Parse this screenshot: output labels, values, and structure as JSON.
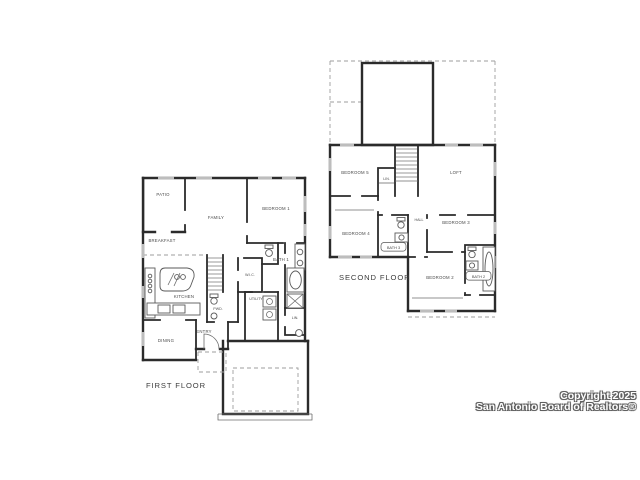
{
  "colors": {
    "background": "#ffffff",
    "wall": "#2b2b2b",
    "fixture_line": "#5a5a5a",
    "window": "#bdbdbd",
    "dashed_line": "#9e9e9e",
    "label_text": "#4a4a4a",
    "watermark_text": "#ffffff",
    "watermark_outline": "#5f5f5f"
  },
  "first_floor": {
    "title": "FIRST FLOOR",
    "rooms": {
      "patio": "PATIO",
      "family": "FAMILY",
      "bedroom1": "BEDROOM 1",
      "breakfast": "BREAKFAST",
      "kitchen": "KITCHEN",
      "dining": "DINING",
      "entry": "ENTRY",
      "powder": "PWD.",
      "utility": "UTILITY",
      "bath1": "BATH 1",
      "wic": "W.I.C.",
      "linen": "LIN."
    }
  },
  "second_floor": {
    "title": "SECOND FLOOR",
    "rooms": {
      "bedroom5": "BEDROOM 5",
      "loft": "LOFT",
      "bedroom4": "BEDROOM 4",
      "hall": "HALL",
      "bedroom3": "BEDROOM 3",
      "bath3": "BATH 3",
      "bedroom2": "BEDROOM 2",
      "bath2": "BATH 2",
      "linen": "LIN."
    }
  },
  "watermark": {
    "line1": "Copyright 2025",
    "line2": "San Antonio Board of Realtors®"
  }
}
